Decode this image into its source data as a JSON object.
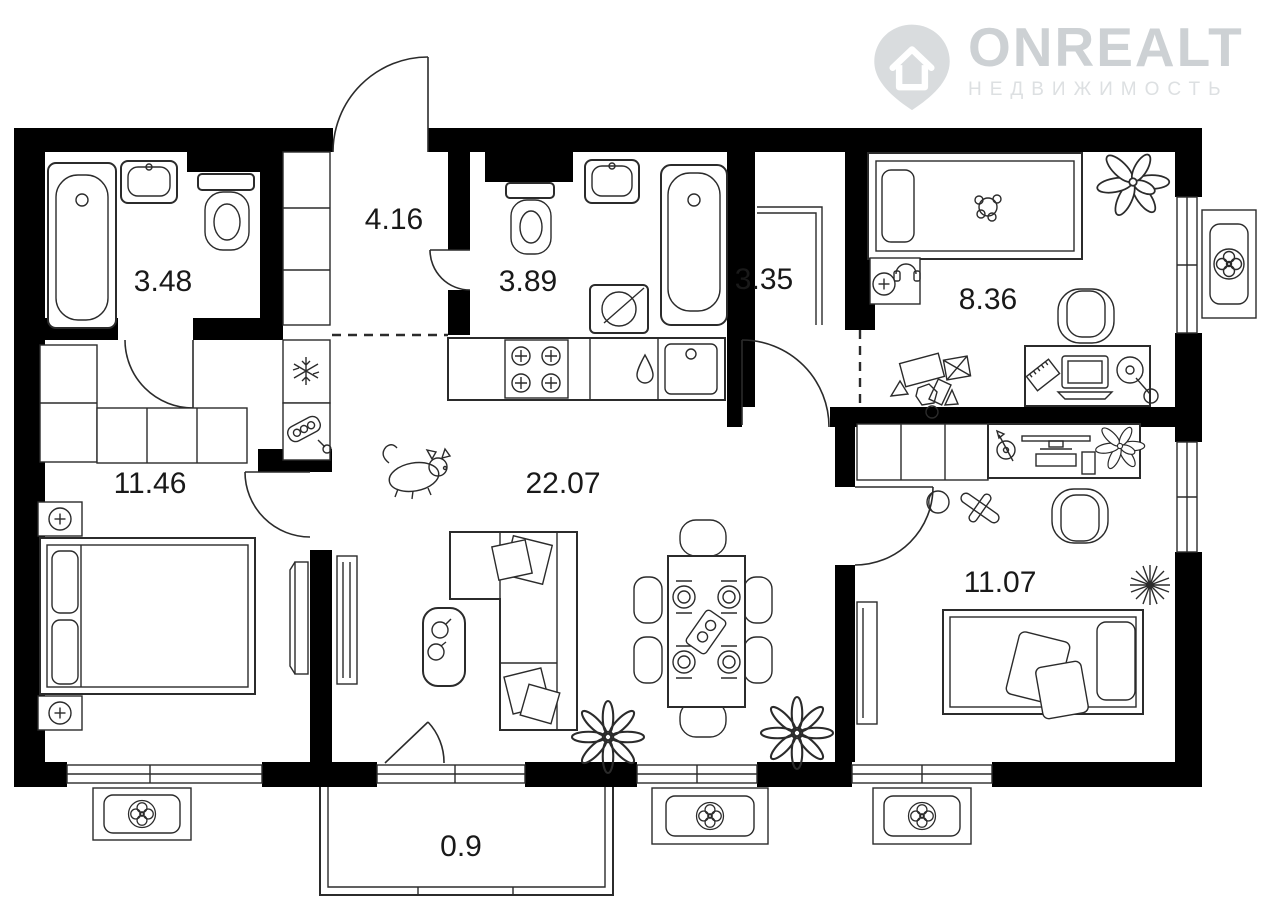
{
  "logo": {
    "brand": "ONREALT",
    "subtitle": "НЕДВИЖИМОСТЬ",
    "icon": "house-pin-icon",
    "color": "#cdd1d4",
    "subtitle_color": "#dde0e2"
  },
  "plan": {
    "type": "apartment-floor-plan",
    "total_rooms_labeled": 9,
    "rooms": {
      "bathroom1": {
        "area": "3.48",
        "kind": "bathroom"
      },
      "hallway": {
        "area": "4.16",
        "kind": "entrance-hall"
      },
      "bathroom2": {
        "area": "3.89",
        "kind": "bathroom"
      },
      "closet": {
        "area": "3.35",
        "kind": "walk-in-closet"
      },
      "child": {
        "area": "8.36",
        "kind": "children-bedroom"
      },
      "master": {
        "area": "11.46",
        "kind": "bedroom"
      },
      "living": {
        "area": "22.07",
        "kind": "living-room-kitchen"
      },
      "bedroom2": {
        "area": "11.07",
        "kind": "bedroom"
      },
      "balcony": {
        "area": "0.9",
        "kind": "balcony"
      }
    },
    "icons": [
      "bathtub-icon",
      "sink-icon",
      "toilet-icon",
      "washing-machine-icon",
      "stove-icon",
      "kitchen-sink-icon",
      "water-drop-icon",
      "fridge-snowflake-icon",
      "water-heater-icon",
      "double-bed-icon",
      "single-bed-icon",
      "nightstand-lamp-icon",
      "wardrobe-icon",
      "sofa-icon",
      "coffee-table-icon",
      "dining-table-icon",
      "chair-icon",
      "desk-icon",
      "laptop-icon",
      "monitor-icon",
      "office-chair-icon",
      "toys-icon",
      "headphones-icon",
      "plant-icon",
      "flower-icon",
      "pet-icon",
      "ac-unit-fan-icon",
      "door-arc-icon",
      "window-icon"
    ],
    "colors": {
      "walls": "#000000",
      "lines": "#2b2b2b",
      "background": "#ffffff"
    }
  }
}
